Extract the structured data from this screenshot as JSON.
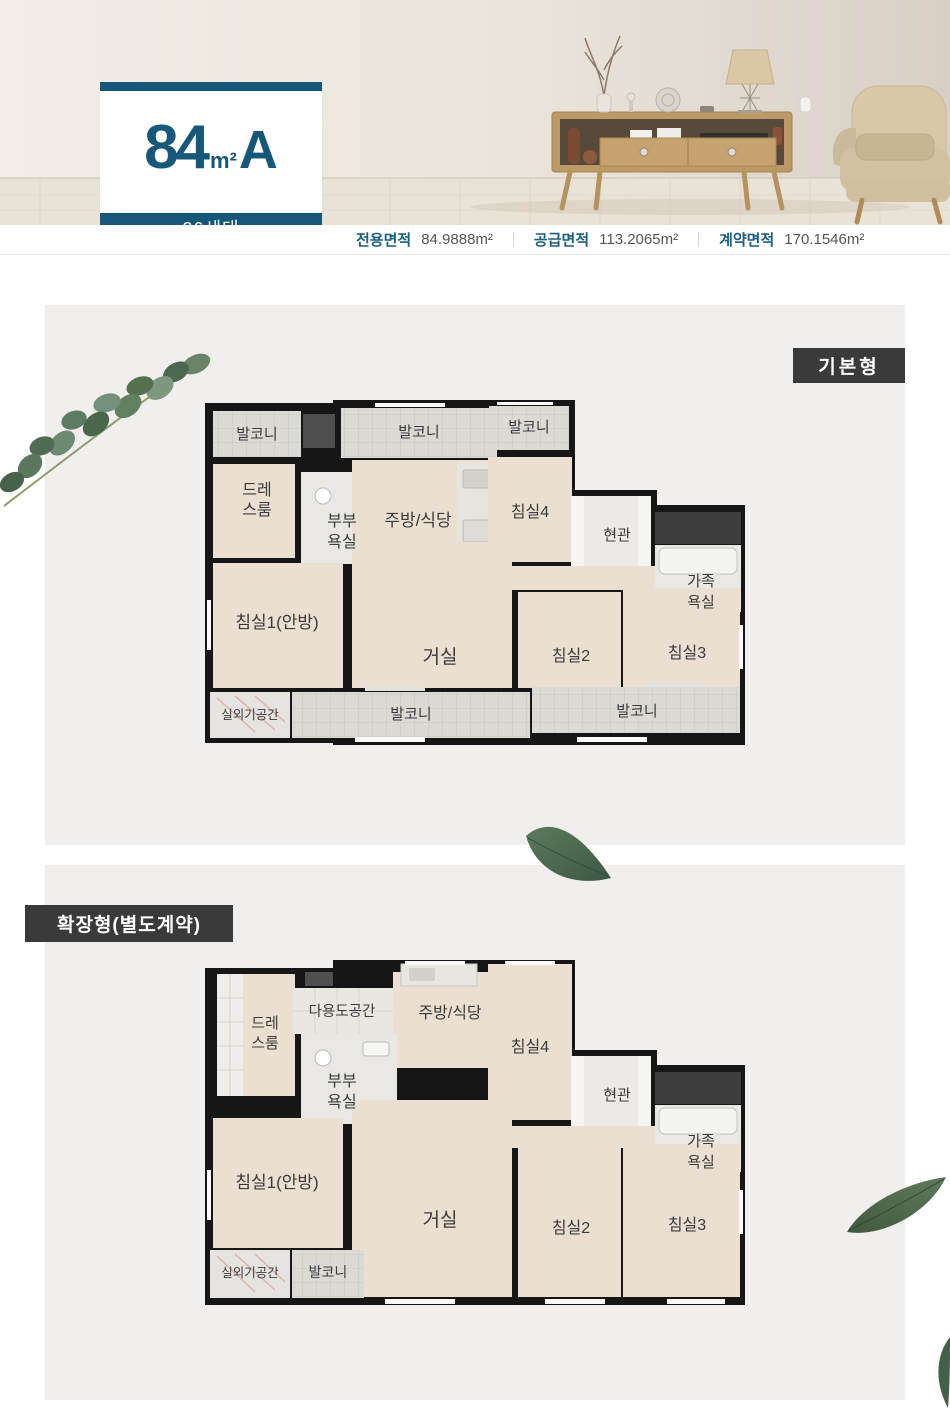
{
  "unit": {
    "number": "84",
    "unit": "m²",
    "type": "A",
    "households": "26세대"
  },
  "area_info": [
    {
      "label": "전용면적",
      "value": "84.9888m²"
    },
    {
      "label": "공급면적",
      "value": "113.2065m²"
    },
    {
      "label": "계약면적",
      "value": "170.1546m²"
    }
  ],
  "badges": {
    "basic": "기본형",
    "extended": "확장형(별도계약)"
  },
  "rooms": {
    "balcony": "발코니",
    "dress_l1": "드레",
    "dress_l2": "스룸",
    "couple_bath_l1": "부부",
    "couple_bath_l2": "욕실",
    "kitchen": "주방/식당",
    "bed4": "침실4",
    "entrance": "현관",
    "family_bath_l1": "가족",
    "family_bath_l2": "욕실",
    "bed1": "침실1(안방)",
    "living": "거실",
    "bed2": "침실2",
    "bed3": "침실3",
    "outdoor_unit": "실외기공간",
    "multi_purpose": "다용도공간"
  },
  "colors": {
    "accent_teal": "#17587a",
    "badge_bg": "#3a3a3a",
    "section_bg": "#f0efed",
    "wall": "#161616",
    "room_fill": "#eadfd0",
    "balcony_fill": "#dbdad5"
  }
}
